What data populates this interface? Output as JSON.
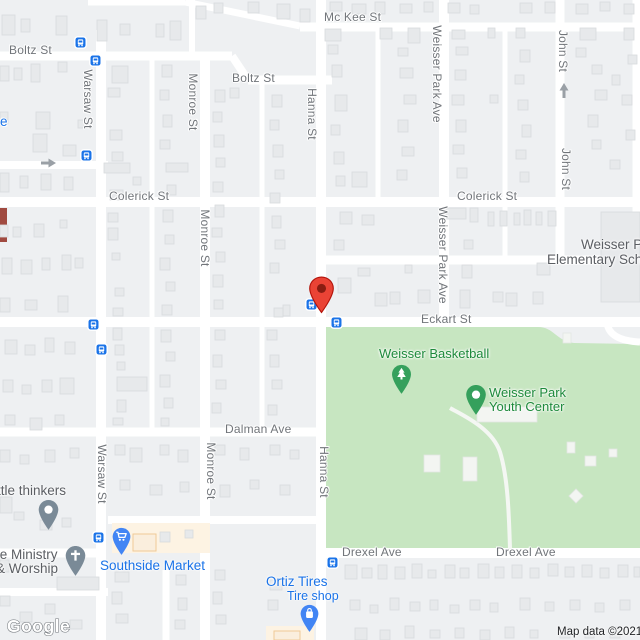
{
  "streets": {
    "mckee": "Mc Kee St",
    "boltz_1": "Boltz St",
    "boltz_2": "Boltz St",
    "colerick_1": "Colerick St",
    "colerick_2": "Colerick St",
    "eckart": "Eckart St",
    "dalman": "Dalman Ave",
    "drexel_1": "Drexel Ave",
    "drexel_2": "Drexel Ave",
    "warsaw_1": "Warsaw St",
    "warsaw_2": "Warsaw St",
    "monroe_1": "Monroe St",
    "monroe_2": "Monroe St",
    "monroe_3": "Monroe St",
    "hanna_1": "Hanna St",
    "hanna_2": "Hanna St",
    "wpa_1": "Weisser Park Ave",
    "wpa_2": "Weisser Park Ave",
    "john_1": "John St",
    "john_2": "John St",
    "fragment_e": "e"
  },
  "pois": {
    "school_line1": "Weisser P",
    "school_line2": "Elementary Sch",
    "basketball": "Weisser Basketball",
    "youth_line1": "Weisser Park",
    "youth_line2": "Youth Center",
    "thinkers": "ttle thinkers",
    "ministry_line1": "fe Ministry",
    "ministry_line2": "& Worship",
    "market": "Southside Market",
    "ortiz_line1": "Ortiz Tires",
    "ortiz_line2": "Tire shop"
  },
  "attribution": {
    "text": "Map data ©2021"
  },
  "watermark": {
    "logo": "Google"
  },
  "icons": {
    "bus_stop": "bus-stop-icon",
    "one_way_right": "one-way-arrow-right-icon",
    "one_way_up": "one-way-arrow-up-icon",
    "red_marker": "red-map-marker",
    "generic_place_pin": "place-pin-icon",
    "church_pin": "church-pin-icon",
    "grocery_pin": "grocery-cart-pin-icon",
    "shopping_bag_pin": "shopping-bag-pin-icon",
    "park_tree_pin": "park-tree-pin-icon",
    "park_dot_pin": "park-dot-pin-icon"
  },
  "colors": {
    "road": "#ffffff",
    "land": "#eef0f2",
    "park_green": "#c7e6c1",
    "building": "#e7e9eb",
    "transit_blue": "#1a73e8",
    "marker_red": "#ea4335",
    "poi_green": "#1e8a3c",
    "poi_blue": "#1a73e8",
    "poi_gray": "#5b5e63",
    "commercial_cream": "#fdf3e3"
  }
}
